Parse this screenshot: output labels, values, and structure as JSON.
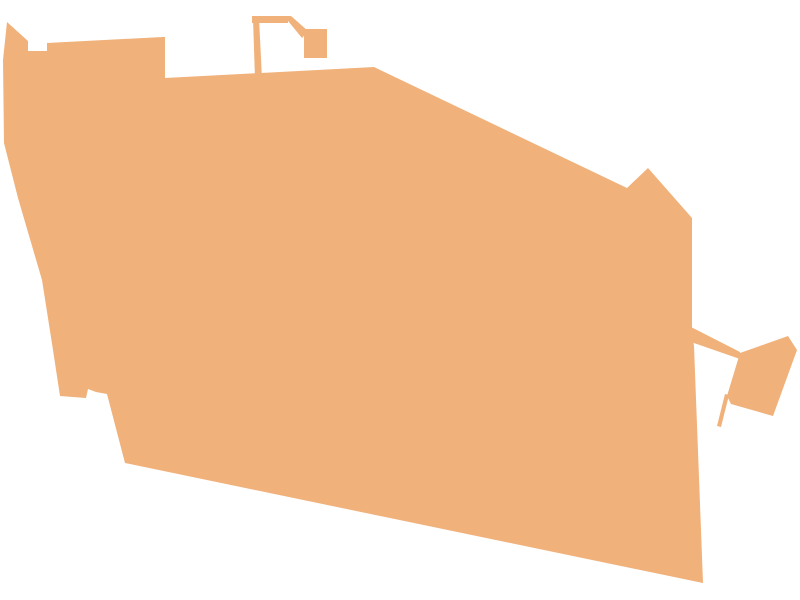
{
  "canvas": {
    "width": 800,
    "height": 600,
    "background_color": "#ffffff"
  },
  "region": {
    "fill_color": "#F0B17A",
    "polygons": [
      {
        "name": "main-body",
        "points": [
          [
            7,
            22
          ],
          [
            28,
            41
          ],
          [
            28,
            51
          ],
          [
            47,
            51
          ],
          [
            47,
            43
          ],
          [
            163,
            37
          ],
          [
            165,
            37
          ],
          [
            165,
            78
          ],
          [
            374,
            67
          ],
          [
            627,
            188
          ],
          [
            648,
            168
          ],
          [
            692,
            218
          ],
          [
            692,
            332
          ],
          [
            694,
            346
          ],
          [
            703,
            583
          ],
          [
            125,
            463
          ],
          [
            107,
            394
          ],
          [
            96,
            392
          ],
          [
            88,
            389
          ],
          [
            86,
            398
          ],
          [
            60,
            396
          ],
          [
            53,
            350
          ],
          [
            42,
            280
          ],
          [
            18,
            198
          ],
          [
            4,
            143
          ],
          [
            3,
            60
          ]
        ]
      },
      {
        "name": "north-pole",
        "points": [
          [
            253,
            18
          ],
          [
            259,
            18
          ],
          [
            262,
            79
          ],
          [
            255,
            79
          ]
        ]
      },
      {
        "name": "north-bar",
        "points": [
          [
            252,
            16
          ],
          [
            288,
            16
          ],
          [
            288,
            23
          ],
          [
            252,
            23
          ]
        ]
      },
      {
        "name": "north-diagonal-band",
        "points": [
          [
            284,
            16
          ],
          [
            291,
            16
          ],
          [
            308,
            31
          ],
          [
            302,
            38
          ]
        ]
      },
      {
        "name": "north-square",
        "points": [
          [
            304,
            29
          ],
          [
            327,
            29
          ],
          [
            327,
            58
          ],
          [
            304,
            58
          ]
        ]
      },
      {
        "name": "east-bridge",
        "points": [
          [
            691,
            327
          ],
          [
            740,
            352
          ],
          [
            740,
            359
          ],
          [
            691,
            342
          ]
        ]
      },
      {
        "name": "east-piece",
        "points": [
          [
            740,
            353
          ],
          [
            788,
            336
          ],
          [
            797,
            350
          ],
          [
            773,
            416
          ],
          [
            731,
            404
          ],
          [
            727,
            396
          ]
        ]
      },
      {
        "name": "east-spike",
        "points": [
          [
            725,
            394
          ],
          [
            729,
            395
          ],
          [
            721,
            427
          ],
          [
            717,
            426
          ]
        ]
      }
    ]
  }
}
